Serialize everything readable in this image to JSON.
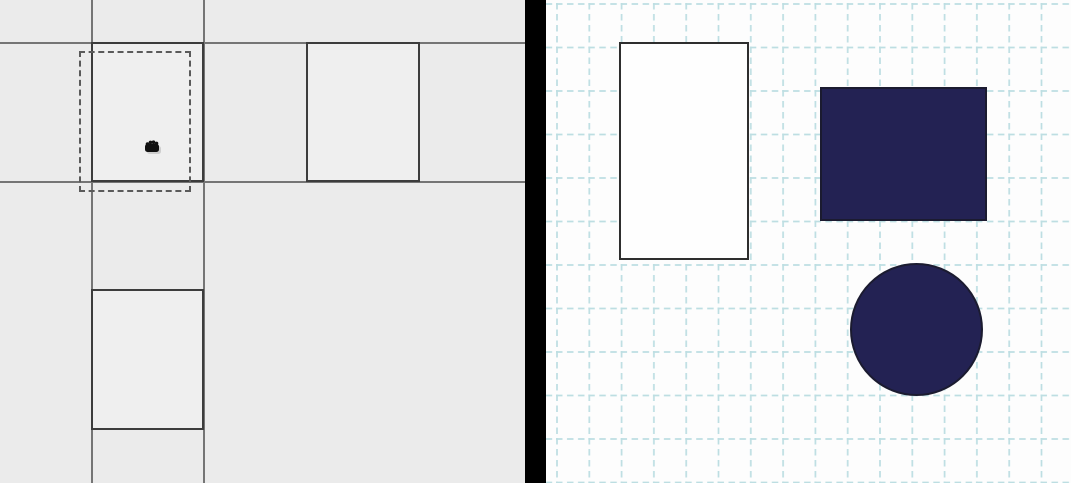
{
  "window": {
    "kind": "side-by-side diagram canvases",
    "width_px": 1071,
    "height_px": 483
  },
  "left_panel": {
    "background_color": "#ebebeb",
    "grid_line_color": "#757575",
    "shape_border_color": "#3c3c3c",
    "shape_fill_color": "#efefef",
    "selection_dash_color": "#5a5a5a",
    "grid_lines": {
      "vertical_x": [
        91,
        203
      ],
      "horizontal_y": [
        42,
        181
      ]
    },
    "shapes": [
      {
        "type": "cell",
        "style": "outlined",
        "x": 91,
        "y": 42,
        "w": 113,
        "h": 140
      },
      {
        "type": "rectangle",
        "style": "outlined",
        "x": 306,
        "y": 42,
        "w": 114,
        "h": 140
      },
      {
        "type": "rectangle",
        "style": "outlined",
        "x": 91,
        "y": 289,
        "w": 113,
        "h": 141
      },
      {
        "type": "drag-preview",
        "style": "dashed",
        "x": 79,
        "y": 51,
        "w": 112,
        "h": 141
      }
    ],
    "cursor": {
      "icon": "grab-hand-cursor",
      "color": "#111111",
      "shadow_color": "#c8c8c8",
      "x": 141,
      "y": 136
    }
  },
  "divider": {
    "color": "#000000"
  },
  "right_panel": {
    "background_color": "#fdfdfd",
    "grid_color": "#bddee2",
    "grid_cell_width": 32.3,
    "grid_cell_height": 43.5,
    "outline_rect_fill": "#fefefe",
    "outline_rect_stroke": "#2e2e2e",
    "shape_fill_color": "#232253",
    "shape_stroke_color": "#1b1b30",
    "shapes": [
      {
        "type": "rectangle",
        "style": "outlined",
        "fill": "white",
        "x": 73,
        "y": 42,
        "w": 130,
        "h": 218
      },
      {
        "type": "rectangle",
        "style": "filled",
        "fill": "navy",
        "x": 274,
        "y": 87,
        "w": 167,
        "h": 134
      },
      {
        "type": "circle",
        "style": "filled",
        "fill": "navy",
        "x": 304,
        "y": 263,
        "w": 133,
        "h": 133
      }
    ]
  }
}
